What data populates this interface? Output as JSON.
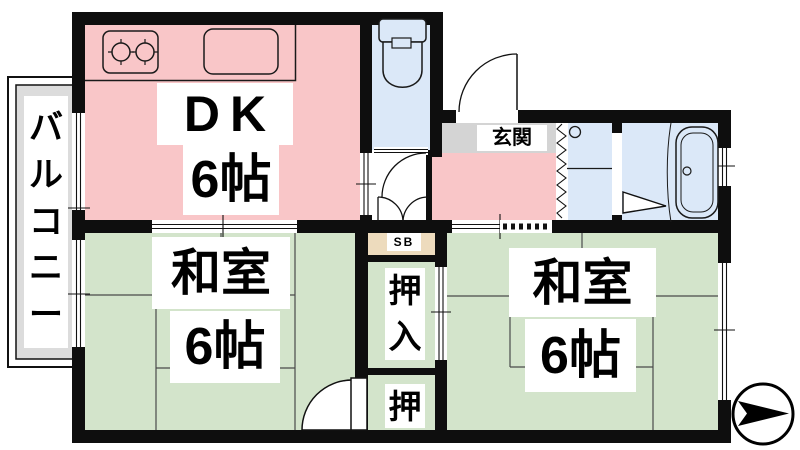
{
  "plan": {
    "type": "japanese-apartment-floor-plan",
    "balcony_label": "バルコニー",
    "dk_label": "DK",
    "dk_size": "6帖",
    "genkan_label": "玄関",
    "shoebox_label": "SB",
    "oshiire_label": "押入",
    "oshi_label": "押",
    "washitsu_left_label": "和室",
    "washitsu_left_size": "6帖",
    "washitsu_right_label": "和室",
    "washitsu_right_size": "6帖"
  },
  "fixtures": {
    "stove": "two-burner-stove-icon",
    "sink": "kitchen-sink-icon",
    "toilet": "toilet-icon",
    "washbasin": "washbasin-icon",
    "bathtub": "bathtub-icon",
    "compass": "north-arrow-icon"
  },
  "colors": {
    "room_pink": "#f9c6c8",
    "room_green": "#d3e4cb",
    "room_blue": "#dbe8f8",
    "genkan_gray": "#d4d4d4",
    "sb_tan": "#eddbbd",
    "balcony_gray": "#dcdcdc",
    "wall_black": "#0e0e0e"
  }
}
